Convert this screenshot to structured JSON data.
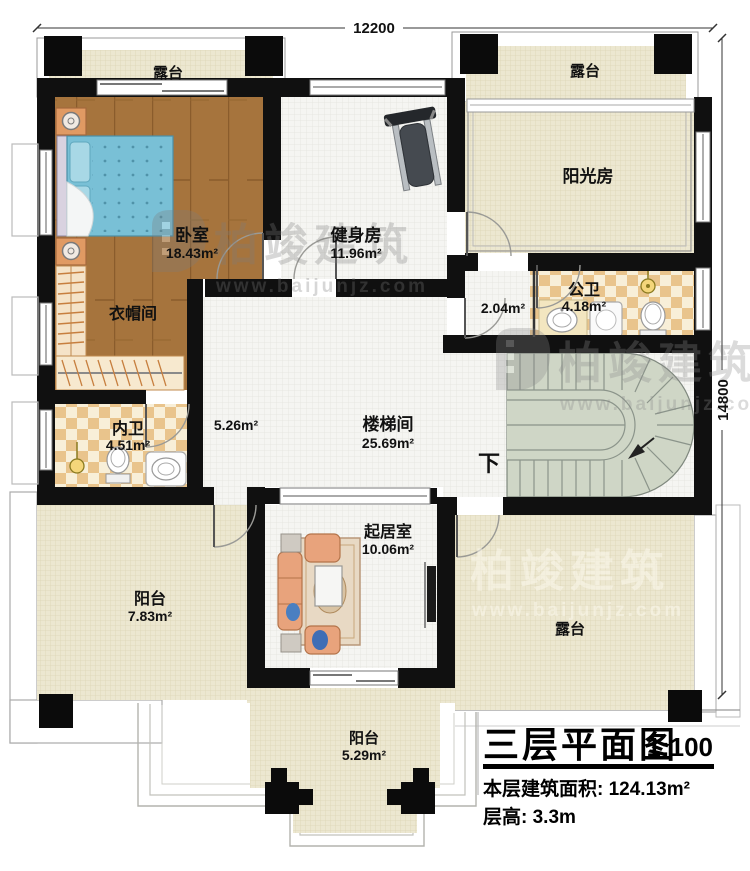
{
  "dimensions": {
    "top": "12200",
    "right": "14800"
  },
  "rooms": {
    "terrace_top_left": {
      "name": "露台"
    },
    "terrace_top_right": {
      "name": "露台"
    },
    "bedroom": {
      "name": "卧室",
      "area": "18.43m²"
    },
    "gym": {
      "name": "健身房",
      "area": "11.96m²"
    },
    "sunroom": {
      "name": "阳光房"
    },
    "public_bath": {
      "name": "公卫",
      "area": "4.18m²"
    },
    "vestibule": {
      "area": "2.04m²"
    },
    "cloakroom": {
      "name": "衣帽间"
    },
    "private_bath": {
      "name": "内卫",
      "area": "4.51m²"
    },
    "corridor": {
      "area": "5.26m²"
    },
    "stair_hall": {
      "name": "楼梯间",
      "area": "25.69m²"
    },
    "stair_direction": "下",
    "living_room": {
      "name": "起居室",
      "area": "10.06m²"
    },
    "balcony_left": {
      "name": "阳台",
      "area": "7.83m²"
    },
    "terrace_bottom_right": {
      "name": "露台"
    },
    "balcony_bottom": {
      "name": "阳台",
      "area": "5.29m²"
    }
  },
  "titleblock": {
    "title": "三层平面图",
    "scale": "1:100",
    "area_label": "本层建筑面积: ",
    "area_value": "124.13m²",
    "height_label": "层高: ",
    "height_value": "3.3m"
  },
  "watermark": {
    "brand": "柏竣建筑",
    "url": "www.baijunjz.com"
  },
  "colors": {
    "wall": "#101010",
    "wood_floor": "#a6743d",
    "outdoor_cream": "#ece7d0",
    "bath_checker": "#e9c48c",
    "stair_green": "#cfd6c6",
    "bed_blue": "#79c0d6",
    "furniture_orange": "#e09a63",
    "sofa_salmon": "#e8a37c"
  }
}
